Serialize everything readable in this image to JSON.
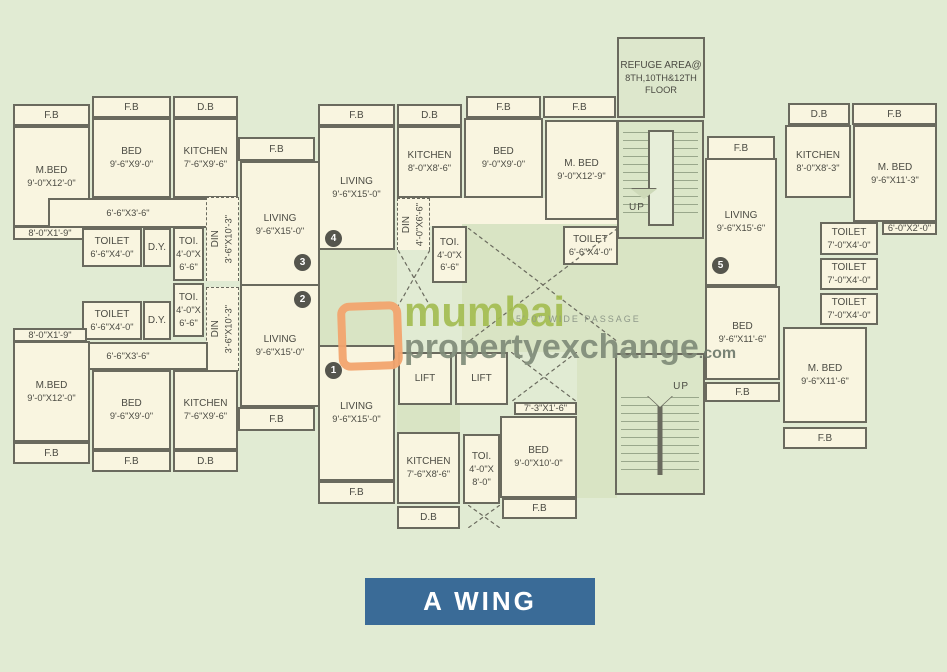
{
  "title": {
    "label": "A WING",
    "bg": "#3a6b97"
  },
  "watermark": {
    "line1": "mumbai",
    "line2": "propertyexchange",
    "suffix": ".com",
    "logo": "orange-rounded-square",
    "line1_color": "#a4bd52",
    "line2_color": "#808c79"
  },
  "passage_label": "5'-0\" WIDE PASSAGE",
  "colors": {
    "page_bg": "#e1ebd3",
    "room_fill": "#f9f5e0",
    "corridor_fill": "#d9e4c4",
    "wall": "#6a6a5e",
    "text": "#4b4b43",
    "title_bg": "#3a6b97"
  },
  "rooms": [
    {
      "key": "u3-fb-mbed",
      "label": "F.B",
      "x": 13,
      "y": 104,
      "w": 77,
      "h": 22
    },
    {
      "key": "u3-fb-bed",
      "label": "F.B",
      "x": 92,
      "y": 96,
      "w": 79,
      "h": 22
    },
    {
      "key": "u3-db",
      "label": "D.B",
      "x": 173,
      "y": 96,
      "w": 65,
      "h": 22
    },
    {
      "key": "u3-mbed",
      "label": "M.BED",
      "dims": "9'-0\"X12'-0\"",
      "x": 13,
      "y": 126,
      "w": 77,
      "h": 101
    },
    {
      "key": "u3-bed",
      "label": "BED",
      "dims": "9'-6\"X9'-0\"",
      "x": 92,
      "y": 118,
      "w": 79,
      "h": 80
    },
    {
      "key": "u3-kitchen",
      "label": "KITCHEN",
      "dims": "7'-6\"X9'-6\"",
      "x": 173,
      "y": 118,
      "w": 65,
      "h": 80
    },
    {
      "key": "u3-hall",
      "dims": "6'-6\"X3'-6\"",
      "x": 48,
      "y": 198,
      "w": 160,
      "h": 30
    },
    {
      "key": "u3-balcony",
      "dims": "8'-0\"X1'-9\"",
      "x": 13,
      "y": 226,
      "w": 74,
      "h": 14
    },
    {
      "key": "u3-toilet",
      "label": "TOILET",
      "dims": "6'-6\"X4'-0\"",
      "x": 82,
      "y": 228,
      "w": 60,
      "h": 39
    },
    {
      "key": "u3-dy",
      "label": "D.Y.",
      "x": 143,
      "y": 228,
      "w": 28,
      "h": 39
    },
    {
      "key": "u3-toi",
      "label": "TOI.",
      "dims": "4'-0\"X 6'-6\"",
      "x": 173,
      "y": 227,
      "w": 31,
      "h": 54
    },
    {
      "key": "u3-din",
      "label": "DIN",
      "dims": "3'-6\"X10'-3\"",
      "x": 206,
      "y": 197,
      "w": 33,
      "h": 84,
      "vertical": true,
      "dashed": true
    },
    {
      "key": "u3-fb-living",
      "label": "F.B",
      "x": 238,
      "y": 137,
      "w": 77,
      "h": 24
    },
    {
      "key": "u3-living",
      "label": "LIVING",
      "dims": "9'-6\"X15'-0\"",
      "x": 240,
      "y": 161,
      "w": 80,
      "h": 127
    },
    {
      "key": "u2-toi",
      "label": "TOI.",
      "dims": "4'-0\"X 6'-6\"",
      "x": 173,
      "y": 283,
      "w": 31,
      "h": 54
    },
    {
      "key": "u2-toilet",
      "label": "TOILET",
      "dims": "6'-6\"X4'-0\"",
      "x": 82,
      "y": 301,
      "w": 60,
      "h": 39
    },
    {
      "key": "u2-dy",
      "label": "D.Y.",
      "x": 143,
      "y": 301,
      "w": 28,
      "h": 39
    },
    {
      "key": "u2-din",
      "label": "DIN",
      "dims": "3'-6\"X10'-3\"",
      "x": 206,
      "y": 287,
      "w": 33,
      "h": 84,
      "vertical": true,
      "dashed": true
    },
    {
      "key": "u2-living",
      "label": "LIVING",
      "dims": "9'-6\"X15'-0\"",
      "x": 240,
      "y": 284,
      "w": 80,
      "h": 123
    },
    {
      "key": "u2-fb-living",
      "label": "F.B",
      "x": 238,
      "y": 407,
      "w": 77,
      "h": 24
    },
    {
      "key": "u2-balcony",
      "dims": "8'-0\"X1'-9\"",
      "x": 13,
      "y": 328,
      "w": 74,
      "h": 14
    },
    {
      "key": "u2-hall",
      "dims": "6'-6\"X3'-6\"",
      "x": 48,
      "y": 342,
      "w": 160,
      "h": 28
    },
    {
      "key": "u2-mbed",
      "label": "M.BED",
      "dims": "9'-0\"X12'-0\"",
      "x": 13,
      "y": 341,
      "w": 77,
      "h": 101
    },
    {
      "key": "u2-bed",
      "label": "BED",
      "dims": "9'-6\"X9'-0\"",
      "x": 92,
      "y": 370,
      "w": 79,
      "h": 80
    },
    {
      "key": "u2-kitchen",
      "label": "KITCHEN",
      "dims": "7'-6\"X9'-6\"",
      "x": 173,
      "y": 370,
      "w": 65,
      "h": 80
    },
    {
      "key": "u2-fb-mbed",
      "label": "F.B",
      "x": 13,
      "y": 442,
      "w": 77,
      "h": 22
    },
    {
      "key": "u2-fb-bed",
      "label": "F.B",
      "x": 92,
      "y": 450,
      "w": 79,
      "h": 22
    },
    {
      "key": "u2-db",
      "label": "D.B",
      "x": 173,
      "y": 450,
      "w": 65,
      "h": 22
    },
    {
      "key": "u4-fb-living",
      "label": "F.B",
      "x": 318,
      "y": 104,
      "w": 77,
      "h": 22
    },
    {
      "key": "u4-db",
      "label": "D.B",
      "x": 397,
      "y": 104,
      "w": 65,
      "h": 22
    },
    {
      "key": "u4-living",
      "label": "LIVING",
      "dims": "9'-6\"X15'-0\"",
      "x": 318,
      "y": 126,
      "w": 77,
      "h": 124
    },
    {
      "key": "u4-kitchen",
      "label": "KITCHEN",
      "dims": "8'-0\"X8'-6\"",
      "x": 397,
      "y": 126,
      "w": 65,
      "h": 72
    },
    {
      "key": "u4-bed",
      "label": "BED",
      "dims": "9'-0\"X9'-0\"",
      "x": 464,
      "y": 118,
      "w": 79,
      "h": 80
    },
    {
      "key": "u4-mbed",
      "label": "M. BED",
      "dims": "9'-0\"X12'-9\"",
      "x": 545,
      "y": 120,
      "w": 73,
      "h": 100
    },
    {
      "key": "u4-fb-bed",
      "label": "F.B",
      "x": 466,
      "y": 96,
      "w": 75,
      "h": 22
    },
    {
      "key": "u4-fb-mbed",
      "label": "F.B",
      "x": 543,
      "y": 96,
      "w": 73,
      "h": 22
    },
    {
      "key": "u4-din",
      "label": "DIN",
      "dims": "4'-0\"X6'-6\"",
      "x": 397,
      "y": 198,
      "w": 33,
      "h": 52,
      "vertical": true,
      "dashed": true
    },
    {
      "key": "u4-toi",
      "label": "TOI.",
      "dims": "4'-0\"X 6'-6\"",
      "x": 432,
      "y": 226,
      "w": 35,
      "h": 57
    },
    {
      "key": "u4-toilet",
      "label": "TOILET",
      "dims": "6'-6\"X4'-0\"",
      "x": 563,
      "y": 226,
      "w": 55,
      "h": 39
    },
    {
      "key": "u1-living",
      "label": "LIVING",
      "dims": "9'-6\"X15'-0\"",
      "x": 318,
      "y": 345,
      "w": 77,
      "h": 136
    },
    {
      "key": "lift-1",
      "label": "LIFT",
      "x": 398,
      "y": 352,
      "w": 54,
      "h": 53
    },
    {
      "key": "lift-2",
      "label": "LIFT",
      "x": 455,
      "y": 352,
      "w": 53,
      "h": 53
    },
    {
      "key": "u1-strip",
      "dims": "7'-3\"X1'-6\"",
      "x": 514,
      "y": 402,
      "w": 63,
      "h": 13
    },
    {
      "key": "u1-bed",
      "label": "BED",
      "dims": "9'-0\"X10'-0\"",
      "x": 500,
      "y": 416,
      "w": 77,
      "h": 82
    },
    {
      "key": "u1-kitchen",
      "label": "KITCHEN",
      "dims": "7'-6\"X8'-6\"",
      "x": 397,
      "y": 432,
      "w": 63,
      "h": 72
    },
    {
      "key": "u1-toi",
      "label": "TOI.",
      "dims": "4'-0\"X 8'-0\"",
      "x": 463,
      "y": 434,
      "w": 37,
      "h": 70
    },
    {
      "key": "u1-fb-living",
      "label": "F.B",
      "x": 318,
      "y": 481,
      "w": 77,
      "h": 23
    },
    {
      "key": "u1-db",
      "label": "D.B",
      "x": 397,
      "y": 506,
      "w": 63,
      "h": 23
    },
    {
      "key": "u1-fb-bed",
      "label": "F.B",
      "x": 502,
      "y": 498,
      "w": 75,
      "h": 21
    },
    {
      "key": "refuge-area",
      "label": "REFUGE AREA@",
      "dims": "8TH,10TH&12TH FLOOR",
      "x": 617,
      "y": 37,
      "w": 88,
      "h": 81,
      "fill": "green"
    },
    {
      "key": "u5-fb-living",
      "label": "F.B",
      "x": 707,
      "y": 136,
      "w": 68,
      "h": 24
    },
    {
      "key": "u5-living",
      "label": "LIVING",
      "dims": "9'-6\"X15'-6\"",
      "x": 705,
      "y": 158,
      "w": 72,
      "h": 128
    },
    {
      "key": "u5-db",
      "label": "D.B",
      "x": 788,
      "y": 103,
      "w": 62,
      "h": 22
    },
    {
      "key": "u5-fb-mbed",
      "label": "F.B",
      "x": 852,
      "y": 103,
      "w": 85,
      "h": 22
    },
    {
      "key": "u5-kitchen",
      "label": "KITCHEN",
      "dims": "8'-0\"X8'-3\"",
      "x": 785,
      "y": 125,
      "w": 66,
      "h": 73
    },
    {
      "key": "u5-mbed-top",
      "label": "M. BED",
      "dims": "9'-6\"X11'-3\"",
      "x": 853,
      "y": 125,
      "w": 84,
      "h": 97
    },
    {
      "key": "u5-strip",
      "dims": "6'-0\"X2'-0\"",
      "x": 882,
      "y": 222,
      "w": 55,
      "h": 13
    },
    {
      "key": "u5-toilet-1",
      "label": "TOILET",
      "dims": "7'-0\"X4'-0\"",
      "x": 820,
      "y": 222,
      "w": 58,
      "h": 33
    },
    {
      "key": "u5-toilet-2",
      "label": "TOILET",
      "dims": "7'-0\"X4'-0\"",
      "x": 820,
      "y": 258,
      "w": 58,
      "h": 32
    },
    {
      "key": "u5-toilet-3",
      "label": "TOILET",
      "dims": "7'-0\"X4'-0\"",
      "x": 820,
      "y": 293,
      "w": 58,
      "h": 32
    },
    {
      "key": "u5-bed",
      "label": "BED",
      "dims": "9'-6\"X11'-6\"",
      "x": 705,
      "y": 286,
      "w": 75,
      "h": 94
    },
    {
      "key": "u5-fb-bed",
      "label": "F.B",
      "x": 705,
      "y": 382,
      "w": 75,
      "h": 20
    },
    {
      "key": "u5-mbed-bottom",
      "label": "M. BED",
      "dims": "9'-6\"X11'-6\"",
      "x": 783,
      "y": 327,
      "w": 84,
      "h": 96
    },
    {
      "key": "u5-fb-mbed-bottom",
      "label": "F.B",
      "x": 783,
      "y": 427,
      "w": 84,
      "h": 22
    }
  ],
  "corridors": [
    {
      "key": "hall-u4",
      "x": 430,
      "y": 198,
      "w": 188,
      "h": 28,
      "fill": "cream"
    },
    {
      "key": "lobby-center",
      "x": 462,
      "y": 224,
      "w": 156,
      "h": 128
    },
    {
      "key": "lobby-mid-passage",
      "x": 318,
      "y": 250,
      "w": 79,
      "h": 96
    },
    {
      "key": "lobby-stairs-link",
      "x": 617,
      "y": 238,
      "w": 88,
      "h": 118
    },
    {
      "key": "lobby-lift-south",
      "x": 397,
      "y": 405,
      "w": 63,
      "h": 28
    },
    {
      "key": "lobby-east-of-bed",
      "x": 577,
      "y": 345,
      "w": 40,
      "h": 153
    }
  ],
  "stairs": [
    {
      "key": "staircase-upper",
      "label": "UP",
      "x": 617,
      "y": 120,
      "w": 87,
      "h": 119,
      "variant": "top"
    },
    {
      "key": "staircase-lower",
      "label": "UP",
      "x": 615,
      "y": 353,
      "w": 90,
      "h": 142,
      "variant": "bottom"
    }
  ],
  "crosses": [
    {
      "key": "duct-lobby",
      "x": 468,
      "y": 228,
      "w": 150,
      "h": 114
    },
    {
      "key": "duct-din",
      "x": 398,
      "y": 250,
      "w": 32,
      "h": 56
    },
    {
      "key": "duct-lifts",
      "x": 511,
      "y": 352,
      "w": 66,
      "h": 50
    },
    {
      "key": "duct-db",
      "x": 468,
      "y": 505,
      "w": 32,
      "h": 23
    }
  ],
  "flat_numbers": [
    {
      "n": "1",
      "x": 333,
      "y": 370
    },
    {
      "n": "2",
      "x": 302,
      "y": 299
    },
    {
      "n": "3",
      "x": 302,
      "y": 262
    },
    {
      "n": "4",
      "x": 333,
      "y": 238
    },
    {
      "n": "5",
      "x": 720,
      "y": 265
    }
  ]
}
